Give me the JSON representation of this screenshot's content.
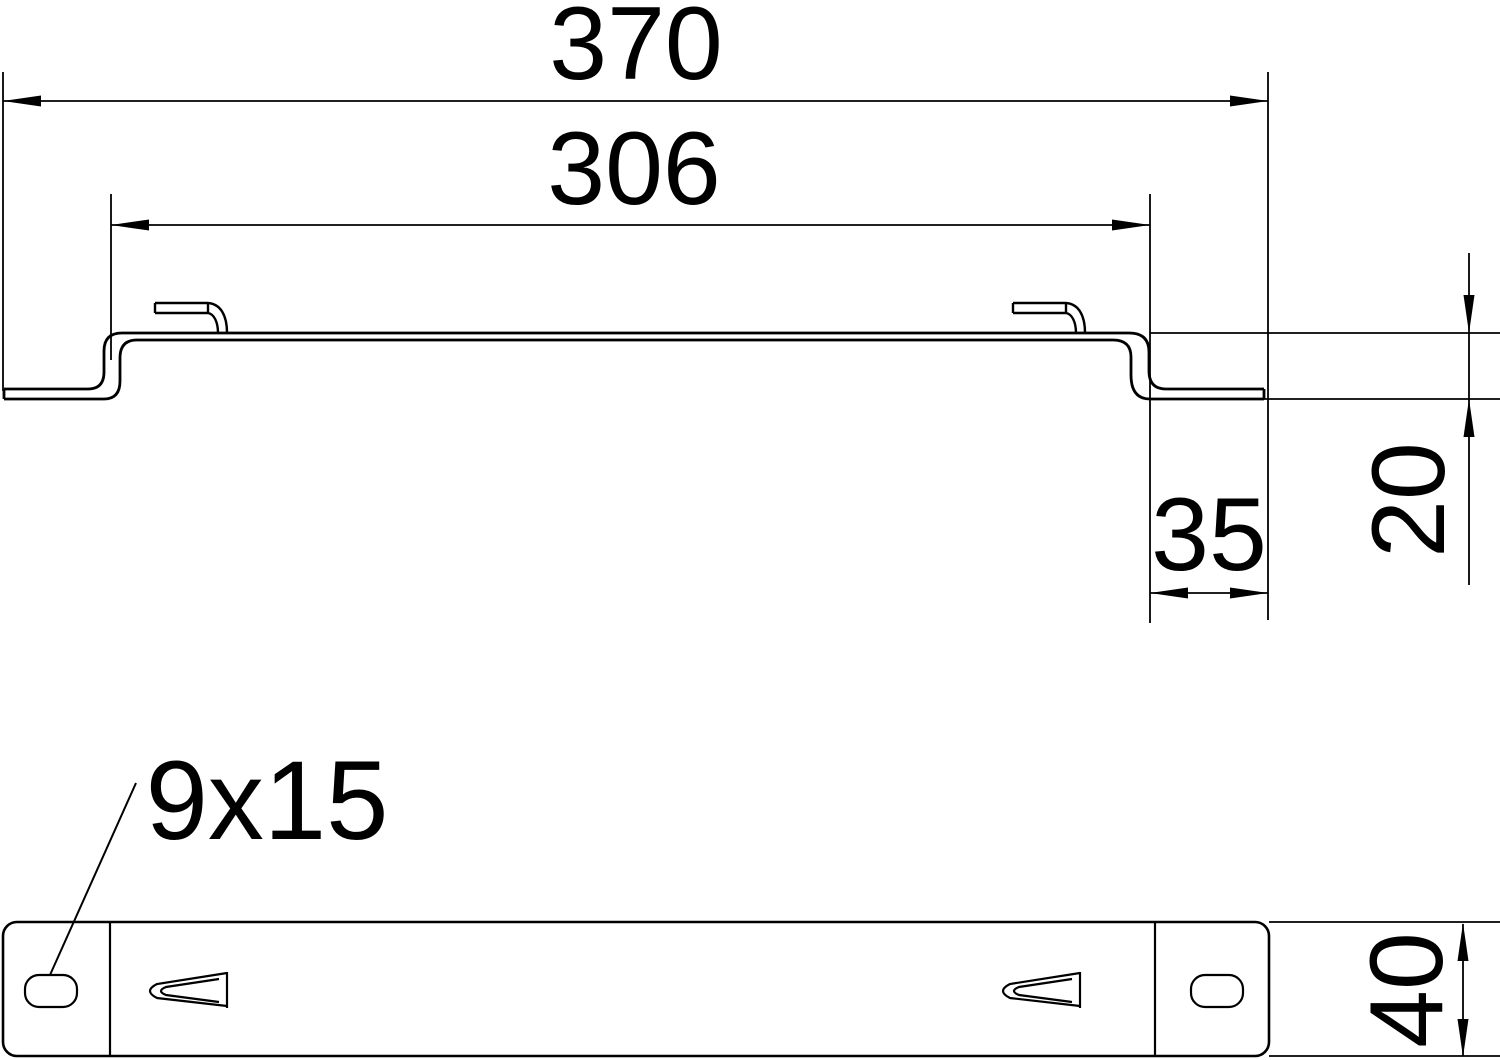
{
  "drawing": {
    "colors": {
      "background": "#ffffff",
      "line": "#000000"
    },
    "dims": {
      "overall_width": "370",
      "inner_width": "306",
      "end_flange_width": "35",
      "profile_depth": "20",
      "slot_size": "9x15",
      "plate_width": "40"
    }
  }
}
